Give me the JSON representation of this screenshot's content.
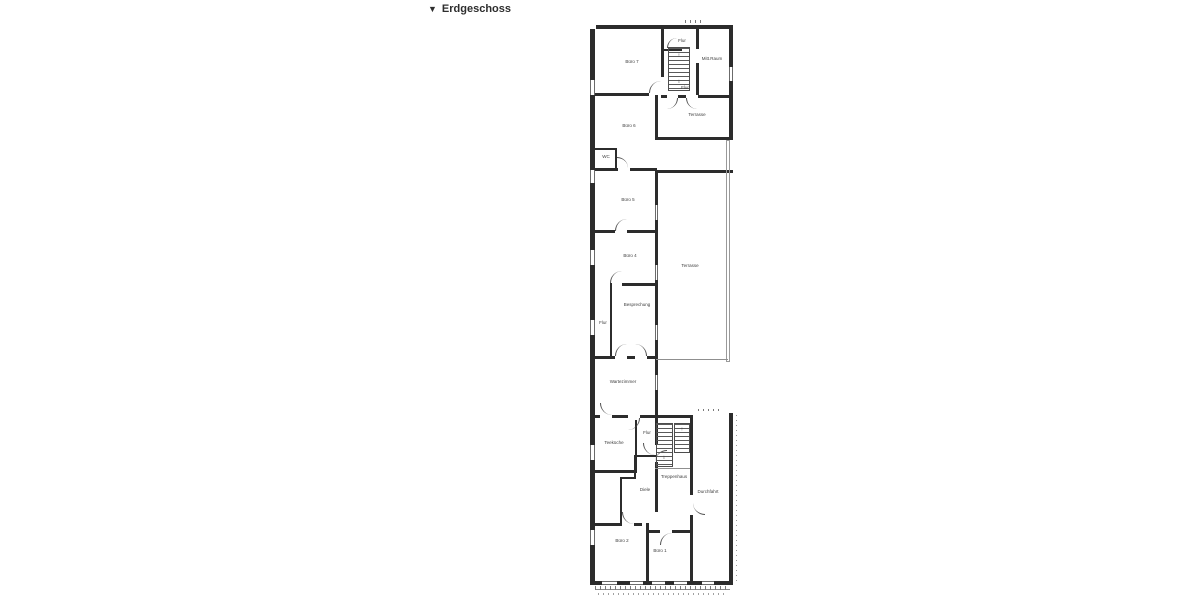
{
  "header": {
    "collapse_icon": "▼",
    "title": "Erdgeschoss"
  },
  "plan": {
    "type": "architectural-floor-plan",
    "floor": "ground floor",
    "rooms": [
      {
        "id": "buero-7",
        "label": "Büro 7"
      },
      {
        "id": "flur-top",
        "label": "Flur"
      },
      {
        "id": "mitt-raum",
        "label": "Mitt.Raum"
      },
      {
        "id": "flur-mid",
        "label": "Flur"
      },
      {
        "id": "terrasse-upper",
        "label": "Terrasse"
      },
      {
        "id": "buero-6",
        "label": "Büro 6"
      },
      {
        "id": "wc",
        "label": "WC"
      },
      {
        "id": "buero-5",
        "label": "Büro 5"
      },
      {
        "id": "buero-4",
        "label": "Büro 4"
      },
      {
        "id": "terrasse-main",
        "label": "Terrasse"
      },
      {
        "id": "besprechung",
        "label": "Besprechung"
      },
      {
        "id": "flur-left",
        "label": "Flur"
      },
      {
        "id": "wartezimmer",
        "label": "Wartezimmer"
      },
      {
        "id": "teekueche",
        "label": "Teeküche"
      },
      {
        "id": "flur-entry",
        "label": "Flur"
      },
      {
        "id": "treppenhaus",
        "label": "Treppenhaus"
      },
      {
        "id": "diele",
        "label": "Diele"
      },
      {
        "id": "durchfahrt",
        "label": "Durchfahrt"
      },
      {
        "id": "buero-2",
        "label": "Büro 2"
      },
      {
        "id": "buero-1",
        "label": "Büro 1"
      }
    ],
    "stairs": {
      "up_arrow": "↑",
      "down_arrow": "↓"
    },
    "colors": {
      "wall": "#2c2c2c",
      "thin_line": "#8f8f8f",
      "label": "#3f3f3f",
      "background": "#ffffff"
    }
  }
}
